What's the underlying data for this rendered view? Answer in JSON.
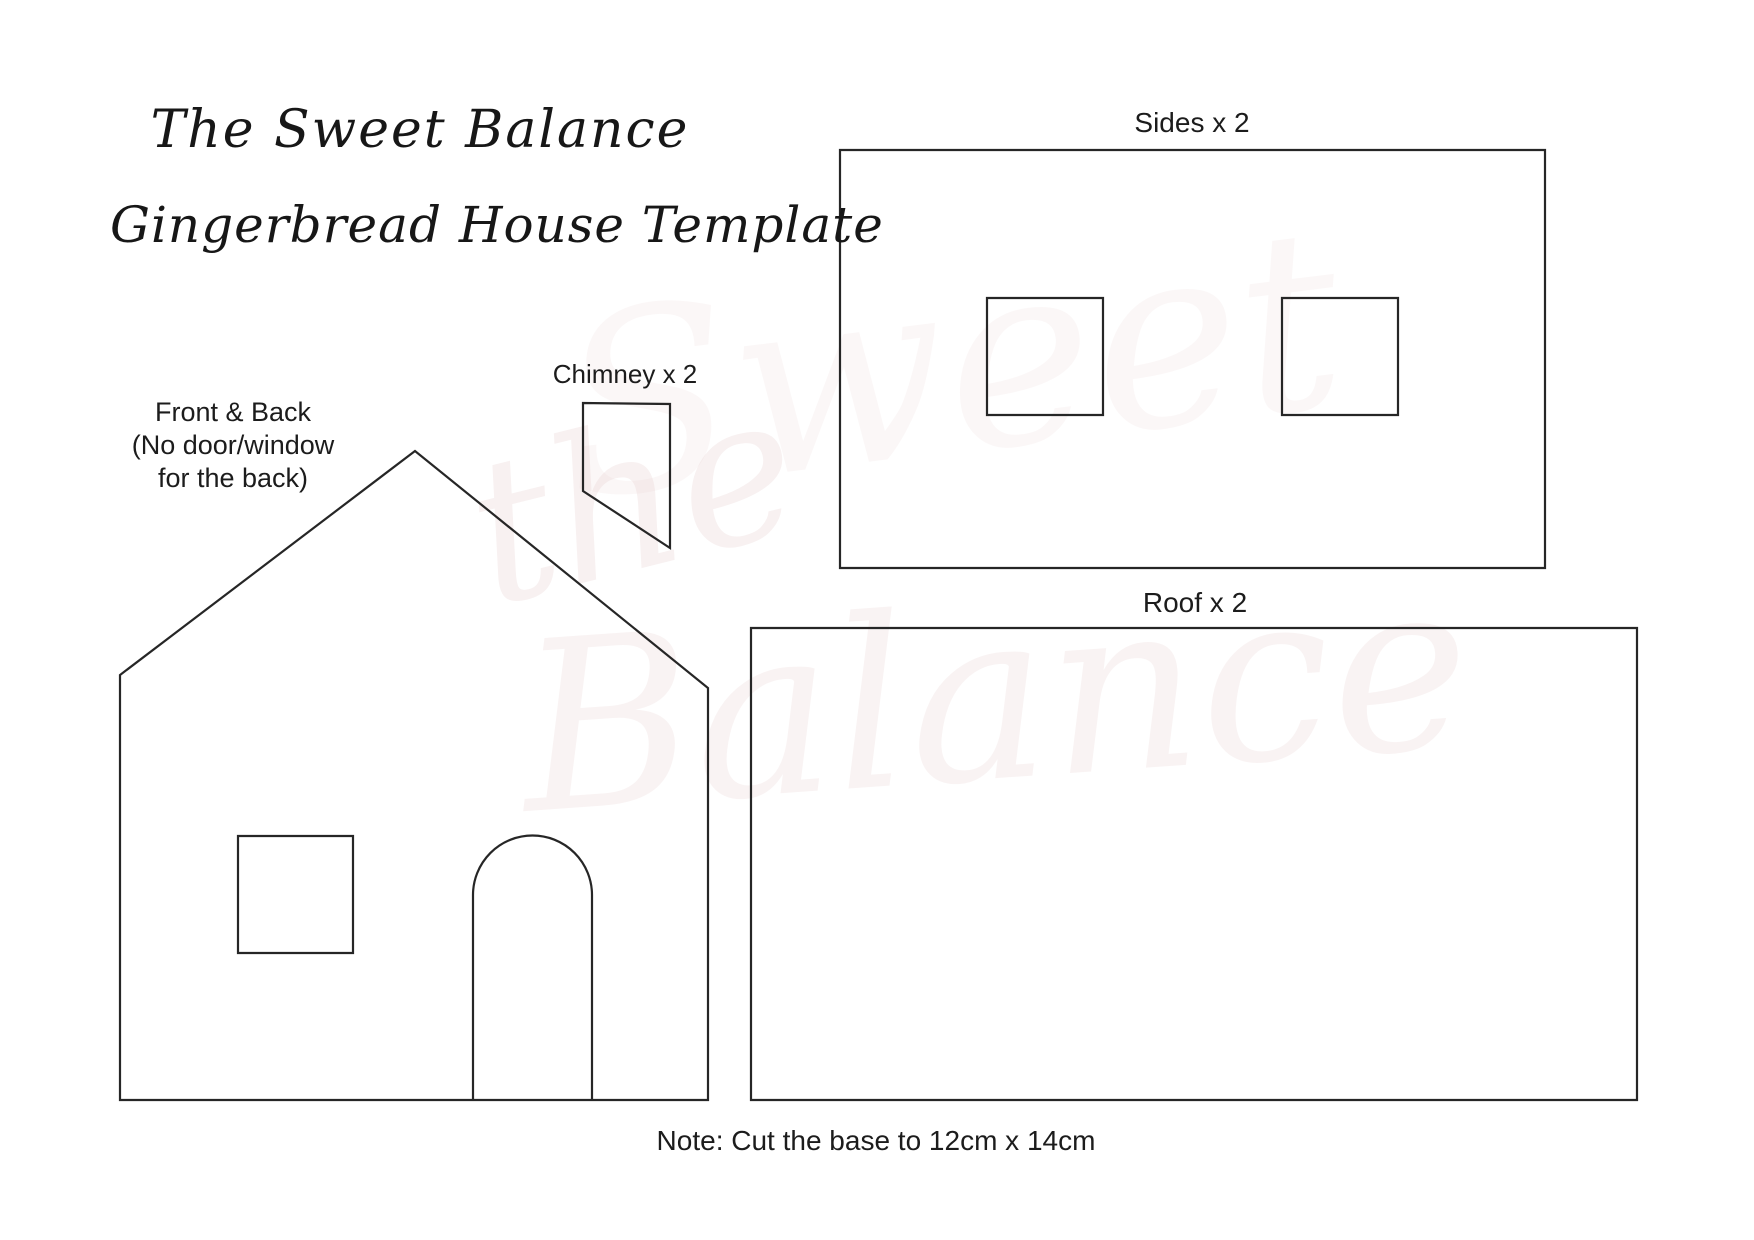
{
  "page": {
    "background_color": "#ffffff",
    "line_color": "#262626",
    "text_color": "#1c1c1c",
    "watermark_color": "#dbb7b7"
  },
  "header": {
    "brand_line": "The Sweet Balance",
    "title_line": "Gingerbread House Template"
  },
  "pieces": {
    "front_back": {
      "label": "Front & Back\n(No door/window\nfor the back)"
    },
    "chimney": {
      "label": "Chimney x 2"
    },
    "sides": {
      "label": "Sides x 2"
    },
    "roof": {
      "label": "Roof x 2"
    }
  },
  "note": {
    "text": "Note: Cut the base to 12cm x 14cm"
  },
  "watermark": {
    "word1": "the",
    "word2": "Sweet",
    "word3": "Balance"
  }
}
